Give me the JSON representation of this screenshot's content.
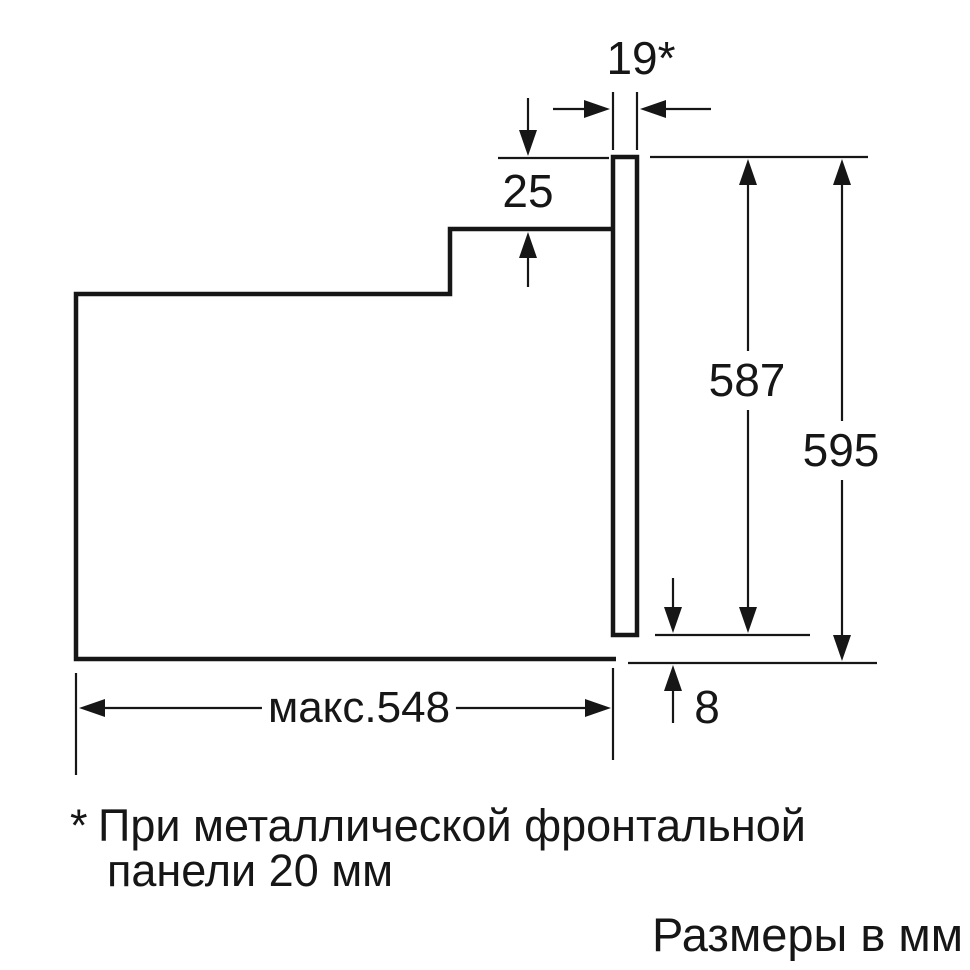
{
  "dimensions": {
    "front_gap": "19*",
    "top_step": "25",
    "inner_height": "587",
    "total_height": "595",
    "bottom_gap": "8",
    "max_depth": "макс.548"
  },
  "footnote": {
    "marker": "*",
    "line1": "При металлической фронтальной",
    "line2": "панели 20 мм"
  },
  "caption": "Размеры в мм",
  "colors": {
    "line": "#161616",
    "background": "#ffffff"
  }
}
